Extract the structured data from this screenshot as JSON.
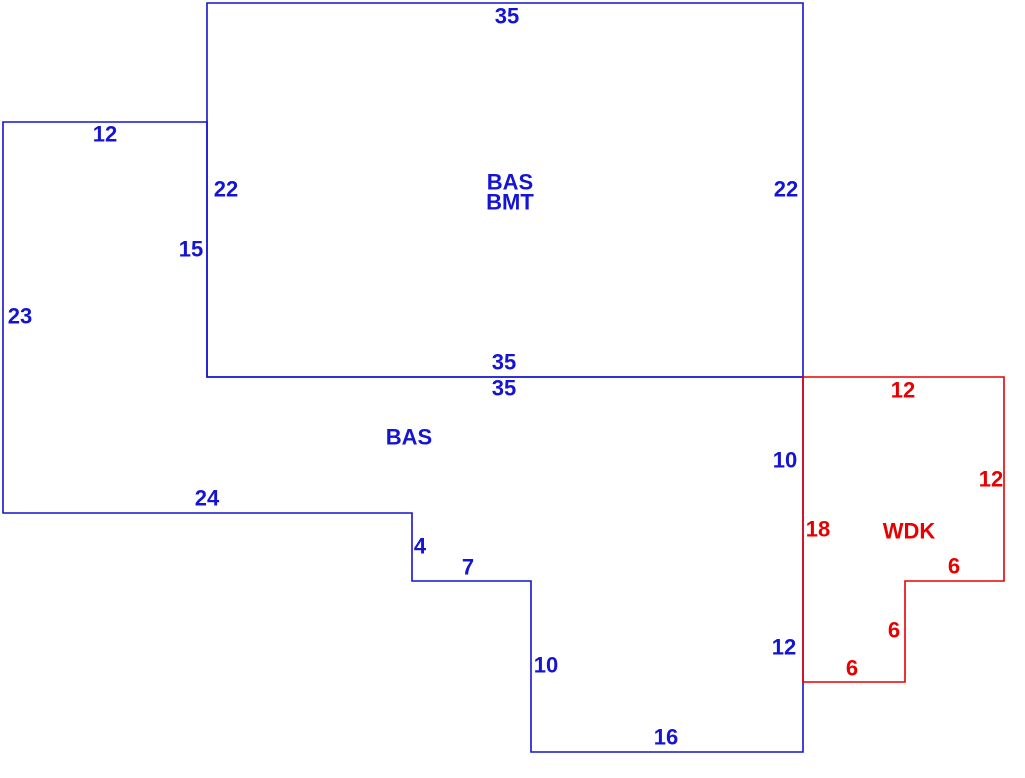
{
  "sketch": {
    "title": "property-sketch",
    "background": "#ffffff",
    "colors": {
      "bas": "#1414d2",
      "wdk": "#e80000"
    },
    "line_width": 1.6,
    "areas": [
      {
        "code": "BAS/BMT",
        "description": "upper rectangle labeled BAS over BMT",
        "color_key": "bas"
      },
      {
        "code": "BAS",
        "description": "lower irregular polygon",
        "color_key": "bas"
      },
      {
        "code": "WDK",
        "description": "wood deck polygon at right",
        "color_key": "wdk"
      }
    ],
    "polygons": [
      {
        "name": "bas-bmt-outline",
        "color_key": "bas",
        "points": [
          [
            207,
            3
          ],
          [
            803,
            3
          ],
          [
            803,
            377
          ],
          [
            207,
            377
          ]
        ]
      },
      {
        "name": "bas-outline",
        "color_key": "bas",
        "points": [
          [
            3,
            122
          ],
          [
            207,
            122
          ],
          [
            207,
            377
          ],
          [
            803,
            377
          ],
          [
            803,
            752
          ],
          [
            531,
            752
          ],
          [
            531,
            581
          ],
          [
            412,
            581
          ],
          [
            412,
            513
          ],
          [
            3,
            513
          ]
        ]
      },
      {
        "name": "wdk-outline",
        "color_key": "wdk",
        "points": [
          [
            803,
            377
          ],
          [
            1004,
            377
          ],
          [
            1004,
            581
          ],
          [
            905,
            581
          ],
          [
            905,
            682
          ],
          [
            803,
            682
          ]
        ]
      }
    ],
    "labels": [
      {
        "name": "dim-top-35",
        "text": "35",
        "x": 507,
        "y": 16,
        "color_key": "bas"
      },
      {
        "name": "dim-upperleft-12",
        "text": "12",
        "x": 105,
        "y": 134,
        "color_key": "bas"
      },
      {
        "name": "dim-left-22",
        "text": "22",
        "x": 226,
        "y": 189,
        "color_key": "bas"
      },
      {
        "name": "area-label-bas-upper",
        "text": "BAS",
        "x": 510,
        "y": 182,
        "color_key": "bas"
      },
      {
        "name": "area-label-bmt",
        "text": "BMT",
        "x": 510,
        "y": 202,
        "color_key": "bas"
      },
      {
        "name": "dim-right-22",
        "text": "22",
        "x": 786,
        "y": 189,
        "color_key": "bas"
      },
      {
        "name": "dim-left-15",
        "text": "15",
        "x": 191,
        "y": 249,
        "color_key": "bas"
      },
      {
        "name": "dim-far-left-23",
        "text": "23",
        "x": 20,
        "y": 316,
        "color_key": "bas"
      },
      {
        "name": "dim-shared-35-above",
        "text": "35",
        "x": 504,
        "y": 362,
        "color_key": "bas"
      },
      {
        "name": "dim-shared-35-below",
        "text": "35",
        "x": 504,
        "y": 388,
        "color_key": "bas"
      },
      {
        "name": "area-label-bas-lower",
        "text": "BAS",
        "x": 409,
        "y": 437,
        "color_key": "bas"
      },
      {
        "name": "dim-bottom-24",
        "text": "24",
        "x": 207,
        "y": 498,
        "color_key": "bas"
      },
      {
        "name": "dim-step-4",
        "text": "4",
        "x": 420,
        "y": 546,
        "color_key": "bas"
      },
      {
        "name": "dim-step-7",
        "text": "7",
        "x": 468,
        "y": 567,
        "color_key": "bas"
      },
      {
        "name": "dim-right-10",
        "text": "10",
        "x": 785,
        "y": 460,
        "color_key": "bas"
      },
      {
        "name": "dim-right-12",
        "text": "12",
        "x": 784,
        "y": 647,
        "color_key": "bas"
      },
      {
        "name": "dim-lower-10",
        "text": "10",
        "x": 546,
        "y": 665,
        "color_key": "bas"
      },
      {
        "name": "dim-bottom-16",
        "text": "16",
        "x": 666,
        "y": 737,
        "color_key": "bas"
      },
      {
        "name": "dim-wdk-top-12",
        "text": "12",
        "x": 903,
        "y": 390,
        "color_key": "wdk"
      },
      {
        "name": "dim-wdk-right-12",
        "text": "12",
        "x": 991,
        "y": 479,
        "color_key": "wdk"
      },
      {
        "name": "area-label-wdk",
        "text": "WDK",
        "x": 909,
        "y": 531,
        "color_key": "wdk"
      },
      {
        "name": "dim-wdk-left-18",
        "text": "18",
        "x": 818,
        "y": 529,
        "color_key": "wdk"
      },
      {
        "name": "dim-wdk-6-top",
        "text": "6",
        "x": 954,
        "y": 566,
        "color_key": "wdk"
      },
      {
        "name": "dim-wdk-6-mid",
        "text": "6",
        "x": 894,
        "y": 630,
        "color_key": "wdk"
      },
      {
        "name": "dim-wdk-6-bottom",
        "text": "6",
        "x": 852,
        "y": 668,
        "color_key": "wdk"
      }
    ]
  }
}
